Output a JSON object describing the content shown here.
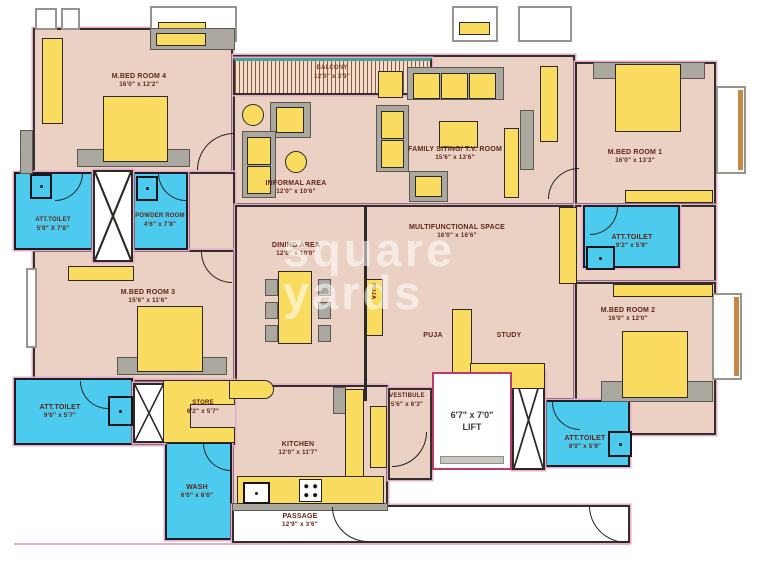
{
  "watermark": {
    "line1": "square",
    "line2": "yards"
  },
  "colors": {
    "floor": "#ead1c3",
    "furniture": "#f9db5f",
    "wet_area": "#4dcbee",
    "wall": "#2d2a26",
    "plan_outline_pink": "#e8accb",
    "lift_border": "#c23b62",
    "label_text": "#5f2617",
    "accent_gray": "#aaa89f"
  },
  "rooms": {
    "bed4": {
      "name": "M.BED ROOM 4",
      "dims": "16'0\" x 12'2\""
    },
    "att_toilet_tl": {
      "name": "ATT.TOILET",
      "dims": "5'9\" X 7'8\""
    },
    "powder": {
      "name": "POWDER ROOM",
      "dims": "4'6\" x 7'8\""
    },
    "balcony": {
      "name": "BALCONY",
      "dims": "12'0\" x 3'9\""
    },
    "informal": {
      "name": "INFORMAL AREA",
      "dims": "12'0\" x 10'6\""
    },
    "family": {
      "name": "FAMILY SITING/ T.V. ROOM",
      "dims": "15'6\" x 13'6\""
    },
    "bed1": {
      "name": "M.BED ROOM 1",
      "dims": "16'0\" x 13'3\""
    },
    "att_toilet_r": {
      "name": "ATT.TOILET",
      "dims": "9'2\" x 5'9\""
    },
    "bed3": {
      "name": "M.BED ROOM 3",
      "dims": "15'6\" x 11'6\""
    },
    "dining": {
      "name": "DINING AREA",
      "dims": "12'0\" x 10'0\""
    },
    "multi": {
      "name": "MULTIFUNCTIONAL SPACE",
      "dims": "16'0\" x 16'6\""
    },
    "puja_unit": {
      "name": "PUJA"
    },
    "puja": {
      "name": "PUJA"
    },
    "study": {
      "name": "STUDY"
    },
    "bed2": {
      "name": "M.BED ROOM 2",
      "dims": "16'0\" x 12'0\""
    },
    "att_toilet_bl": {
      "name": "ATT.TOILET",
      "dims": "9'6\" x 5'7\""
    },
    "att_toilet_br": {
      "name": "ATT.TOILET",
      "dims": "8'0\" x 5'9\""
    },
    "store": {
      "name": "STORE",
      "dims": "6'2\" x 5'7\""
    },
    "vestibule": {
      "name": "VESTIBULE",
      "dims": "5'6\" x 6'3\""
    },
    "lift": {
      "name": "LIFT",
      "dims": "6'7\" x 7'0\""
    },
    "kitchen": {
      "name": "KITCHEN",
      "dims": "12'0\" x 11'7\""
    },
    "wash": {
      "name": "WASH",
      "dims": "6'0\" x 8'6\""
    },
    "passage": {
      "name": "PASSAGE",
      "dims": "12'9\" x 3'6\""
    }
  }
}
